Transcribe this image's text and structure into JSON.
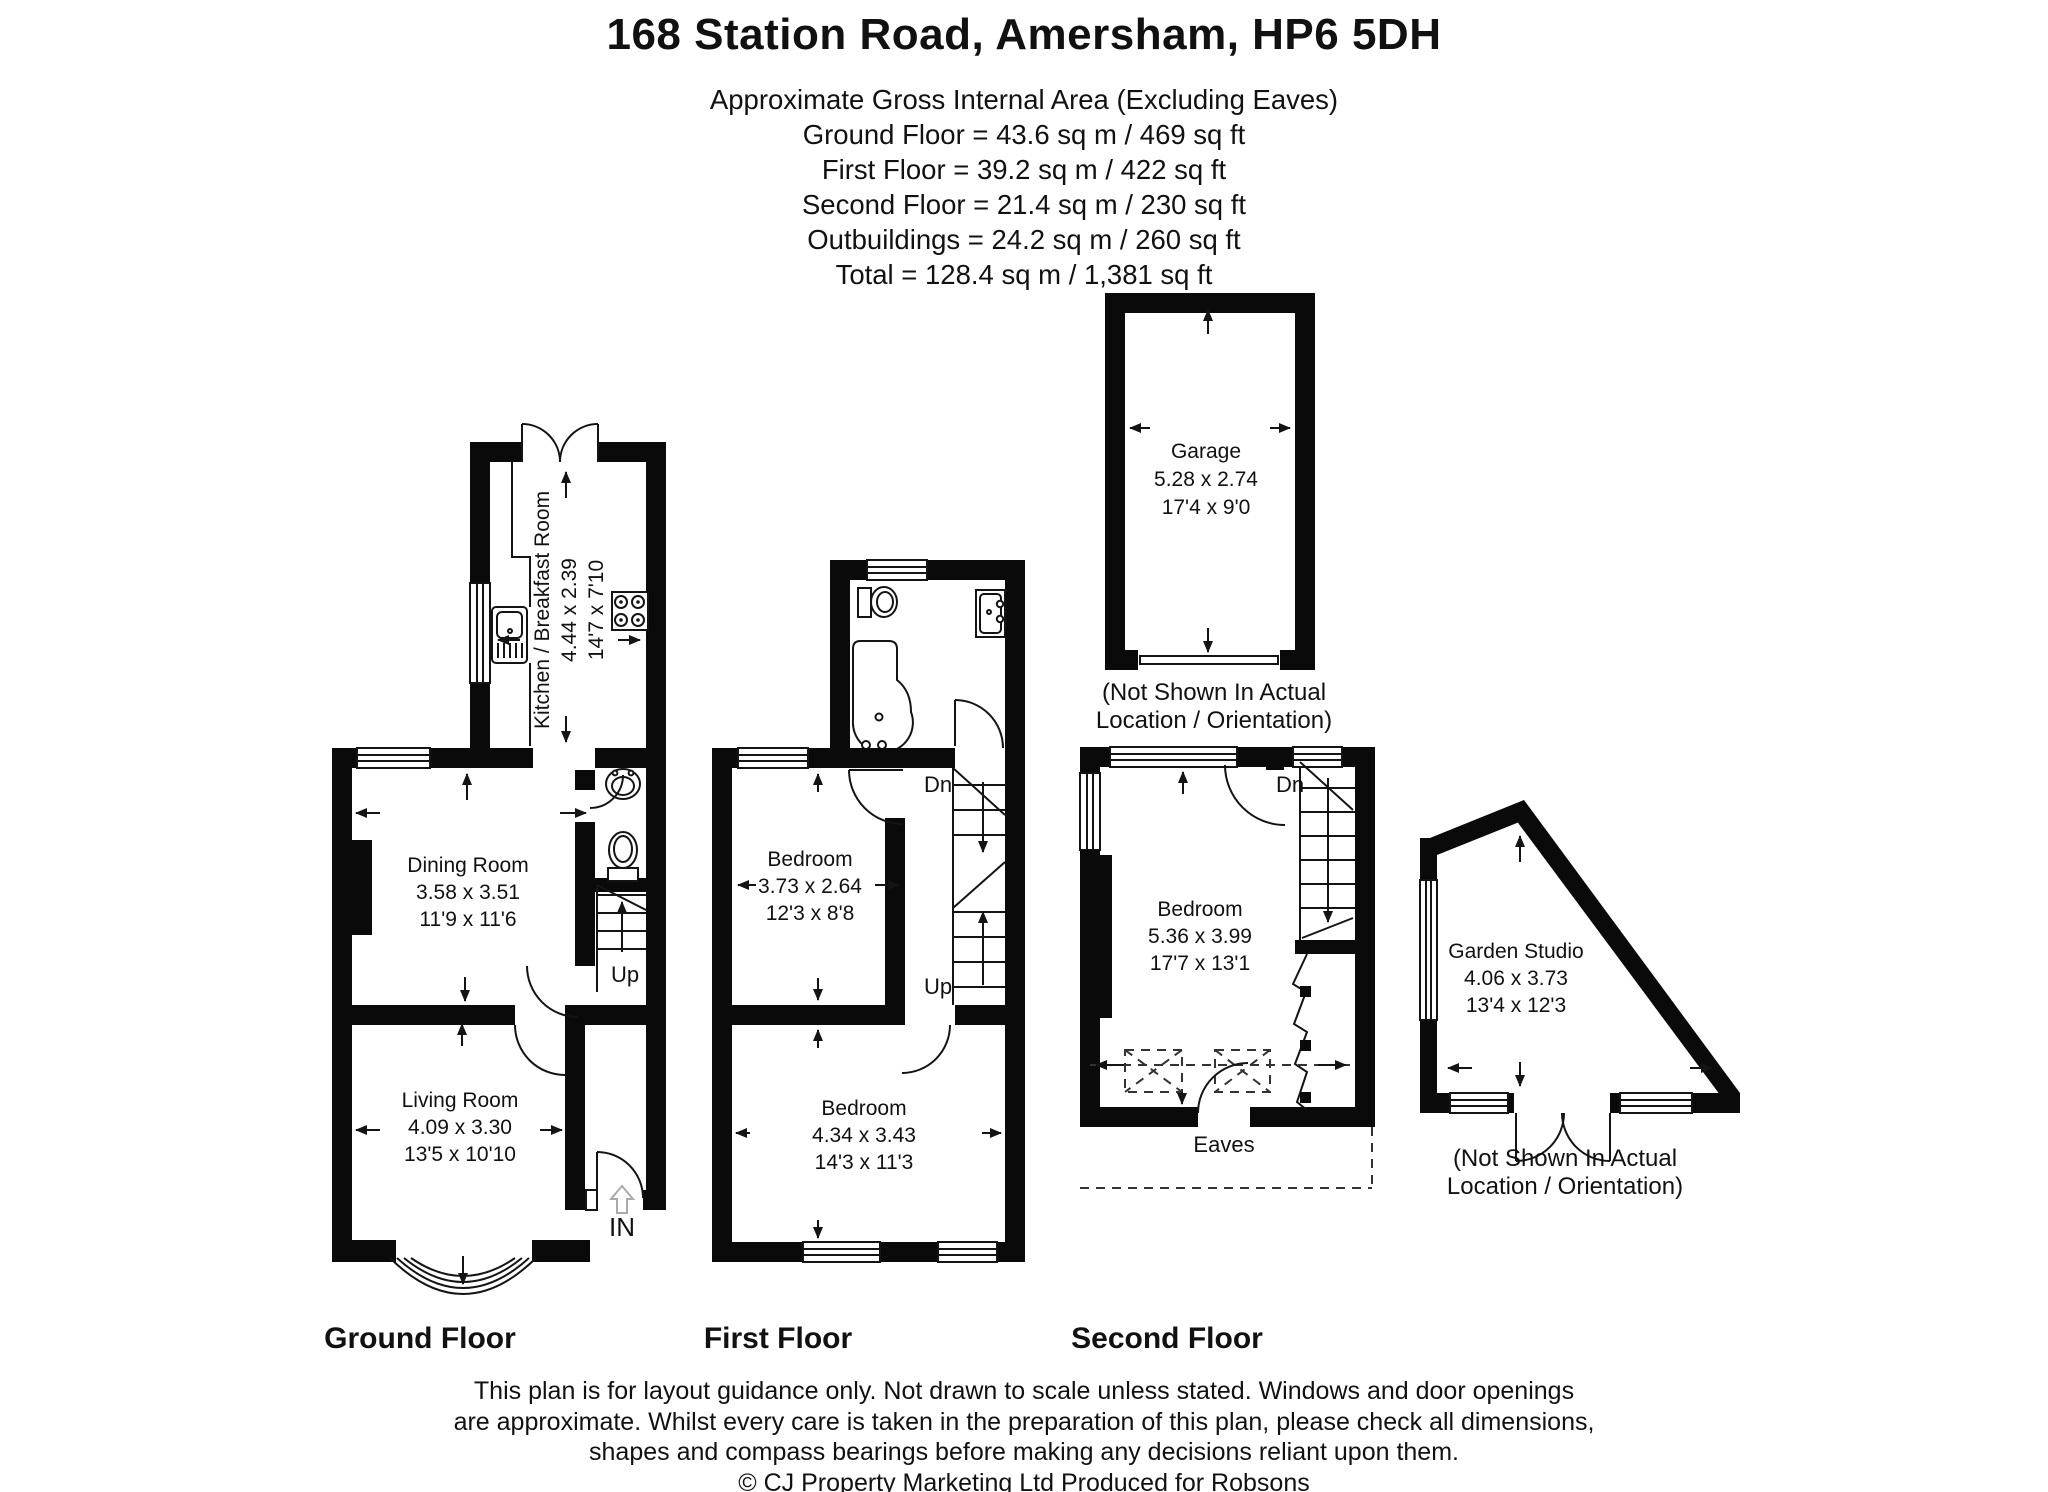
{
  "header": {
    "title": "168 Station Road, Amersham, HP6 5DH",
    "subtitle": "Approximate Gross Internal Area (Excluding Eaves)",
    "areas": [
      "Ground Floor = 43.6 sq m / 469 sq ft",
      "First Floor = 39.2 sq m / 422 sq ft",
      "Second Floor = 21.4 sq m / 230 sq ft",
      "Outbuildings = 24.2 sq m / 260 sq ft",
      "Total = 128.4 sq m / 1,381 sq ft"
    ]
  },
  "floors": {
    "ground_label": "Ground Floor",
    "first_label": "First Floor",
    "second_label": "Second Floor"
  },
  "rooms": {
    "kitchen": {
      "name": "Kitchen / Breakfast Room",
      "metric": "4.44 x 2.39",
      "imperial": "14'7 x 7'10"
    },
    "dining": {
      "name": "Dining Room",
      "metric": "3.58 x 3.51",
      "imperial": "11'9 x 11'6"
    },
    "living": {
      "name": "Living Room",
      "metric": "4.09 x 3.30",
      "imperial": "13'5 x 10'10"
    },
    "first_bedroom_back": {
      "name": "Bedroom",
      "metric": "3.73 x 2.64",
      "imperial": "12'3 x 8'8"
    },
    "first_bedroom_front": {
      "name": "Bedroom",
      "metric": "4.34 x 3.43",
      "imperial": "14'3 x 11'3"
    },
    "second_bedroom": {
      "name": "Bedroom",
      "metric": "5.36 x 3.99",
      "imperial": "17'7 x 13'1"
    },
    "garage": {
      "name": "Garage",
      "metric": "5.28 x 2.74",
      "imperial": "17'4 x 9'0"
    },
    "garden_studio": {
      "name": "Garden Studio",
      "metric": "4.06 x 3.73",
      "imperial": "13'4 x 12'3"
    }
  },
  "markers": {
    "up": "Up",
    "down": "Dn",
    "entrance": "IN",
    "eaves": "Eaves"
  },
  "notes": {
    "not_shown_line1": "(Not Shown In Actual",
    "not_shown_line2": "Location / Orientation)"
  },
  "footer": {
    "line1": "This plan is for layout guidance only. Not drawn to scale unless stated. Windows and door openings",
    "line2": "are approximate. Whilst every care is taken in the preparation of this plan, please check all dimensions,",
    "line3": "shapes and compass bearings before making any decisions reliant upon them.",
    "copyright": "© CJ Property Marketing Ltd Produced for Robsons"
  }
}
